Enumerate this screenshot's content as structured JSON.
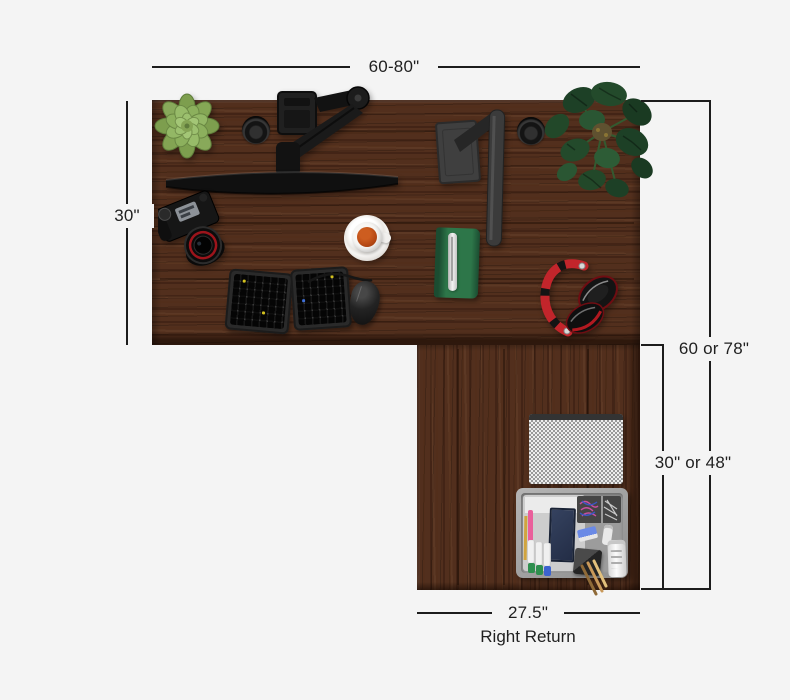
{
  "page": {
    "background": "#f4f4f4"
  },
  "diagram": {
    "line_color": "#1c1c1c",
    "text_color": "#1f1f1f",
    "dimensions": {
      "top_width": "60-80\"",
      "left_depth": "30\"",
      "right_total_length": "60 or 78\"",
      "return_inner_length": "30\" or 48\"",
      "return_width": "27.5\"",
      "return_caption": "Right Return"
    },
    "desk": {
      "wood_color": "#522f1d",
      "accent_colors": {
        "headphones_red": "#c2252b",
        "tea_orange": "#b84a15",
        "notebook_green": "#2d7649",
        "succulent_green": "#8cb05d",
        "monstera_green": "#1d4026"
      },
      "items": [
        "succulent-plant",
        "cable-grommet-left",
        "monitor-arm",
        "monitor",
        "desk-lamp",
        "cable-grommet-right",
        "monstera-plant",
        "dslr-camera",
        "tea-cup-with-saucer",
        "notebook-with-pen",
        "split-ergonomic-keyboard",
        "vertical-mouse",
        "red-headphones",
        "speckled-mouse-pad",
        "drawer-organizer"
      ]
    }
  }
}
